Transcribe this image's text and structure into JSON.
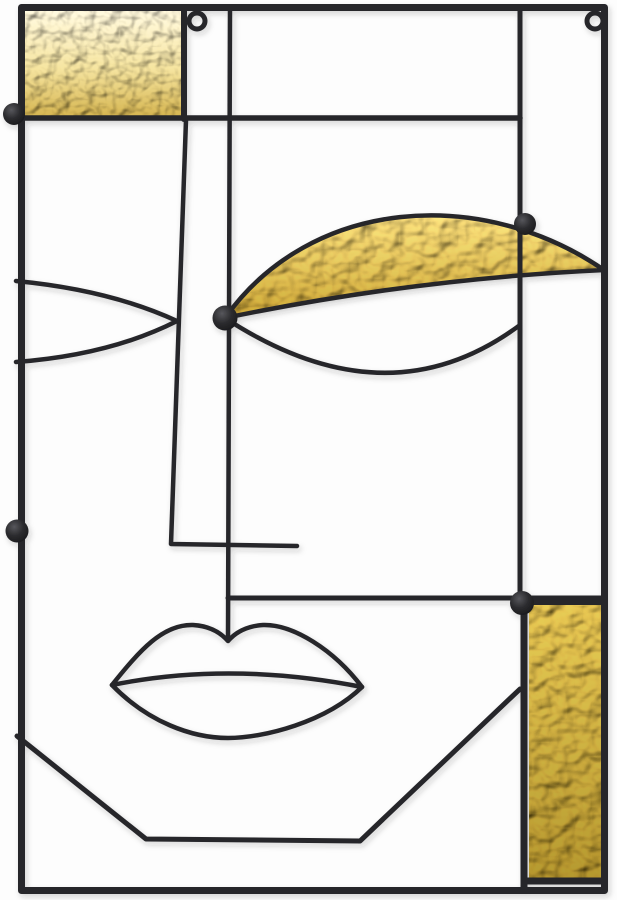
{
  "artwork": {
    "description": "Abstract face wall decor made of black metal wire with hammered gold glass inserts",
    "scene": {
      "type": "product-photo",
      "subject": "abstract-face-metal-wall-art",
      "hanging_rings": 2,
      "gold_glass_panels": 3,
      "rivet_caps": 5
    },
    "colors": {
      "background": "#fdfdfd",
      "metal": "#26262a",
      "frame_metal": "#2a2a2d",
      "dot_highlight": "#57575c",
      "dot_mid": "#2c2c2f",
      "dot_dark": "#141416",
      "pale_gold_top": "#f2ecda",
      "pale_gold_mid": "#e7d79b",
      "pale_gold_deep": "#c9ab4f",
      "crescent_gold_light": "#e9d688",
      "crescent_gold_deep": "#bd9e3a",
      "panel_gold_light": "#d6bd5a",
      "panel_gold_deep": "#a78e32",
      "shadow": "#2b2b2b"
    }
  }
}
